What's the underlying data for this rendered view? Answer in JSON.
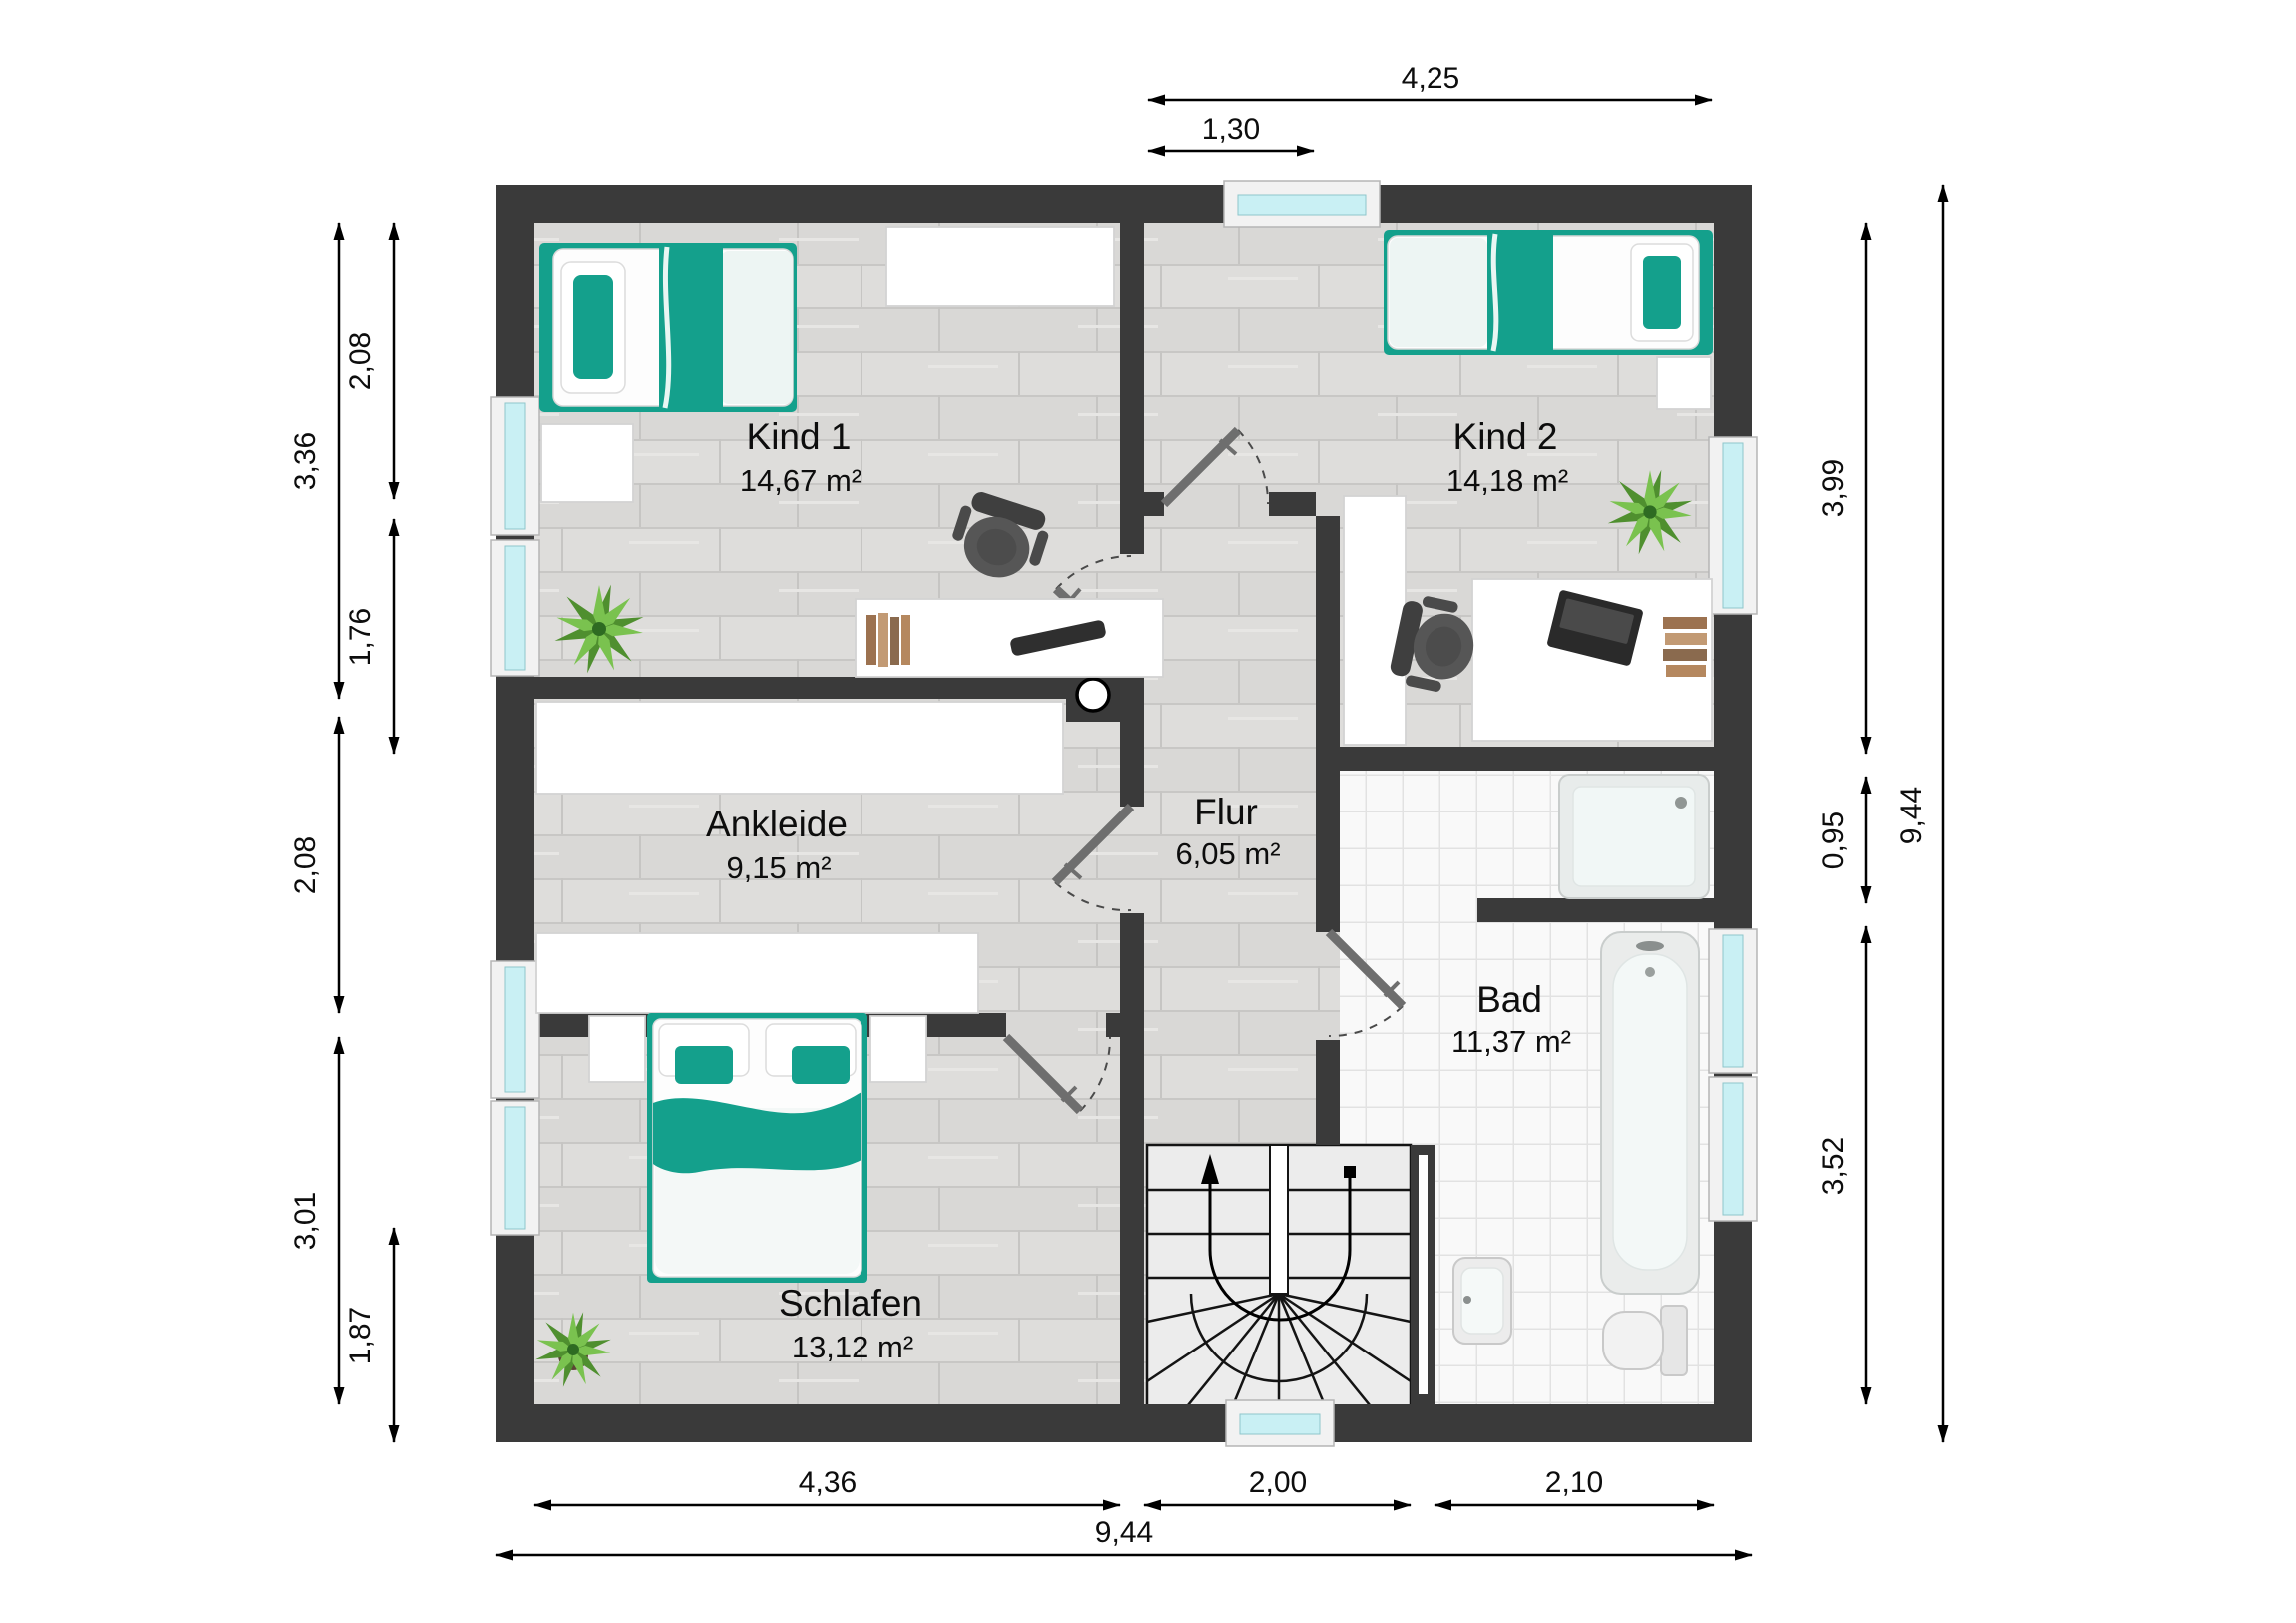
{
  "rooms": {
    "kind1": {
      "name": "Kind 1",
      "area": "14,67 m²"
    },
    "kind2": {
      "name": "Kind 2",
      "area": "14,18 m²"
    },
    "ankleide": {
      "name": "Ankleide",
      "area": "9,15 m²"
    },
    "flur": {
      "name": "Flur",
      "area": "6,05 m²"
    },
    "bad": {
      "name": "Bad",
      "area": "11,37 m²"
    },
    "schlafen": {
      "name": "Schlafen",
      "area": "13,12 m²"
    }
  },
  "dimensions": {
    "top_overall": "4,25",
    "top_window": "1,30",
    "bottom_schlafen": "4,36",
    "bottom_stairs": "2,00",
    "bottom_bad": "2,10",
    "bottom_total": "9,44",
    "left_kind1": "3,36",
    "left_ankleide": "2,08",
    "left_schlafen": "3,01",
    "left_inner_windows": "2,08",
    "left_inner_mid": "1,76",
    "left_inner_low": "1,87",
    "right_kind2": "3,99",
    "right_shower_nook": "0,95",
    "right_bad": "3,52",
    "right_total": "9,44"
  },
  "colors": {
    "wall": "#3a3a3a",
    "accent_teal": "#14a08c",
    "window_glass": "#c9f0f4",
    "wood_floor": "#dcdbd9",
    "tile_floor": "#f9f9f9",
    "plant_green": "#6aac3e"
  },
  "icons": {
    "single-bed-icon": "rect-with-teal-blanket",
    "double-bed-icon": "rect-with-teal-runner",
    "desk-icon": "white-rect",
    "office-chair-icon": "dark-gray-seat",
    "wardrobe-icon": "white-rect",
    "plant-icon": "green-radial-leaves",
    "shower-icon": "rounded-square-drain",
    "bathtub-icon": "rounded-rect-oval",
    "washbasin-icon": "rounded-square-tap",
    "toilet-icon": "bowl-and-tank",
    "stairs-icon": "winder-stairs-up-arrow",
    "door-icon": "gray-leaf-dashed-swing",
    "window-icon": "cyan-glass-band",
    "chimney-icon": "dark-block-white-circle"
  }
}
